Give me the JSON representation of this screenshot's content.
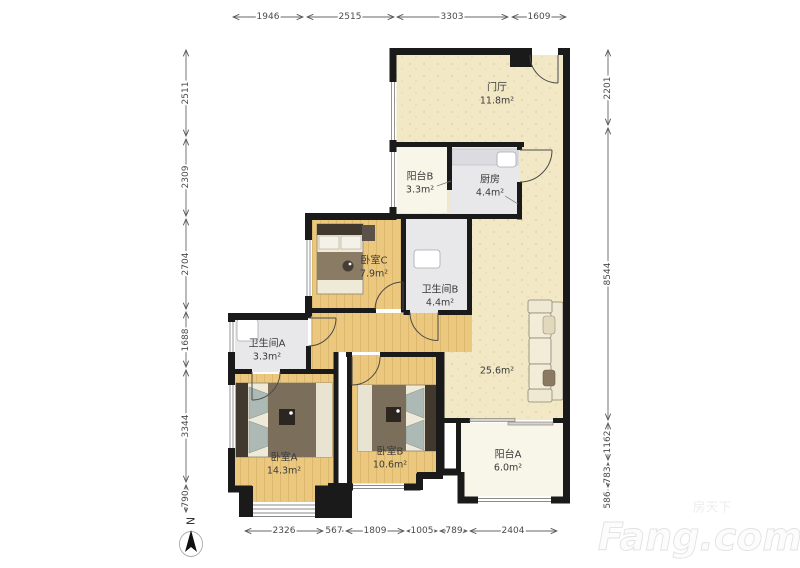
{
  "rooms": {
    "entry": {
      "name": "门厅",
      "area": "11.8m²"
    },
    "balcony_b": {
      "name": "阳台B",
      "area": "3.3m²"
    },
    "kitchen": {
      "name": "厨房",
      "area": "4.4m²"
    },
    "bedroom_c": {
      "name": "卧室C",
      "area": "7.9m²"
    },
    "bath_b": {
      "name": "卫生间B",
      "area": "4.4m²"
    },
    "bath_a": {
      "name": "卫生间A",
      "area": "3.3m²"
    },
    "living": {
      "name": "",
      "area": "25.6m²"
    },
    "bedroom_a": {
      "name": "卧室A",
      "area": "14.3m²"
    },
    "bedroom_b": {
      "name": "卧室B",
      "area": "10.6m²"
    },
    "balcony_a": {
      "name": "阳台A",
      "area": "6.0m²"
    }
  },
  "dimensions": {
    "top": [
      "1946",
      "2515",
      "3303",
      "1609"
    ],
    "left": [
      "2511",
      "2309",
      "2704",
      "1688",
      "3344",
      "790"
    ],
    "right": [
      "2201",
      "8544",
      "1162",
      "783",
      "586"
    ],
    "bottom": [
      "2326",
      "567",
      "1809",
      "1005",
      "789",
      "2404"
    ]
  },
  "compass": {
    "north_label": "N"
  },
  "watermark": {
    "brand_cn": "房天下",
    "brand_en": "Fang.com"
  },
  "colors": {
    "wall": "#1a1a1a",
    "floor_cream": "#f2e8c5",
    "floor_wood": "#ebc87e",
    "wood_line": "#c9a35c",
    "floor_tile": "#e8e7ea",
    "floor_balcony": "#f8f5e9",
    "dim": "#4a4a4a",
    "text": "#3a3a3a",
    "watermark": "#ededed"
  }
}
